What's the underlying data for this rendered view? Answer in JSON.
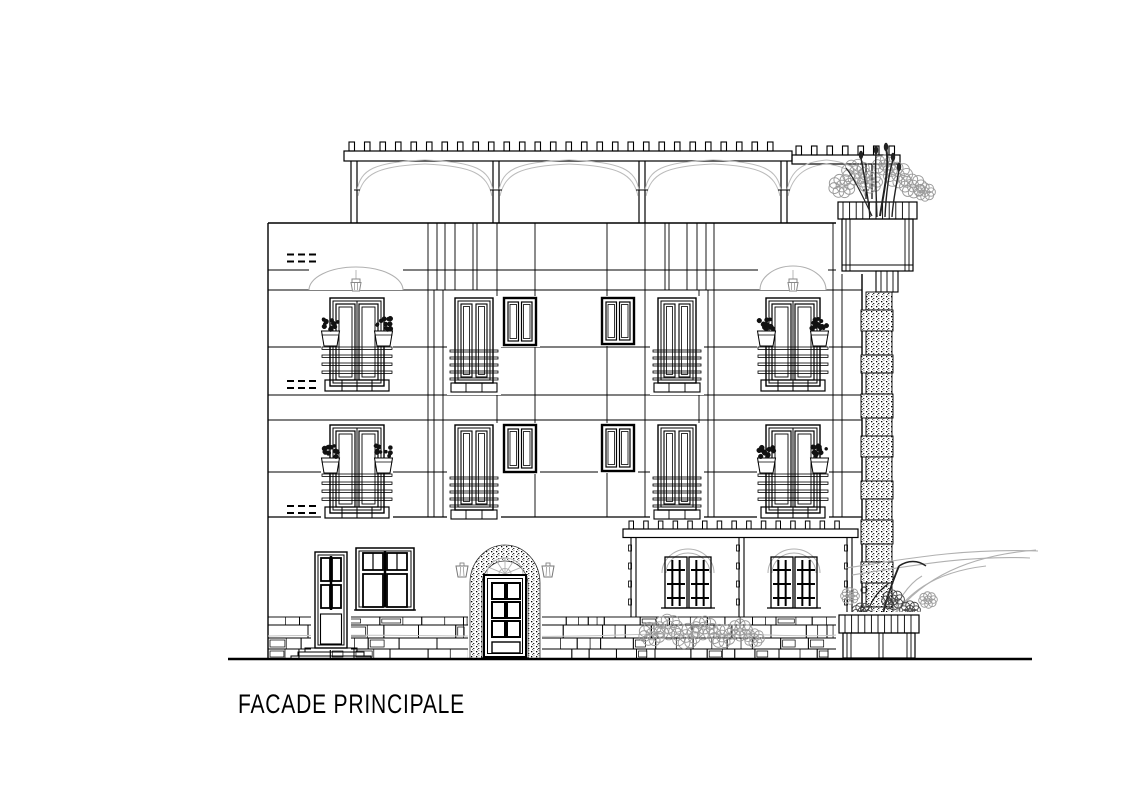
{
  "drawing": {
    "title": "FACADE PRINCIPALE"
  },
  "colors": {
    "ink": "#000000",
    "soft": "#b0b0b0",
    "mid": "#888888",
    "foliage_gray": "#9a9a9a",
    "paper": "#ffffff"
  }
}
